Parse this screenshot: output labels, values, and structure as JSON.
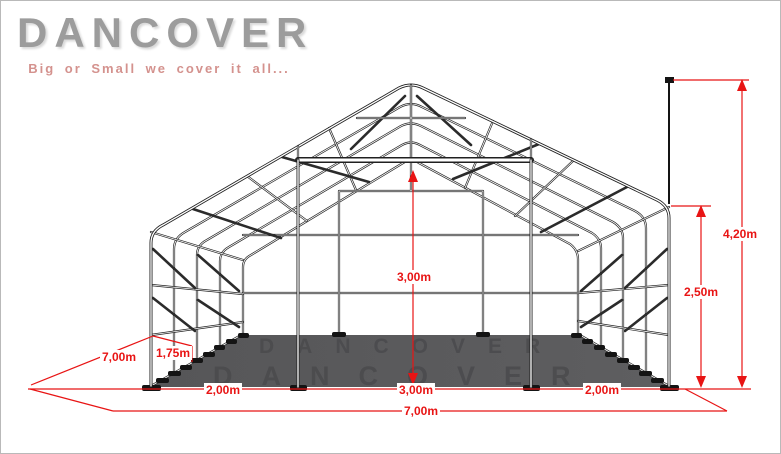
{
  "logo": {
    "brand": "DANCOVER",
    "tagline": "Big or Small we cover it all..."
  },
  "floor_watermark": {
    "text": "DANCOVER"
  },
  "dimensions": {
    "total_height": "4,20m",
    "side_height": "2,50m",
    "interior_height": "3,00m",
    "door_width": "3,00m",
    "left_bay_width": "2,00m",
    "right_bay_width": "2,00m",
    "total_width": "7,00m",
    "total_depth": "7,00m",
    "frame_spacing": "1,75m"
  },
  "colors": {
    "dimension_red": "#e81414",
    "frame_black": "#202020",
    "floor_gray": "#59595b",
    "logo_gray": "#9c9c9c",
    "tagline_pink": "#d4928e"
  }
}
